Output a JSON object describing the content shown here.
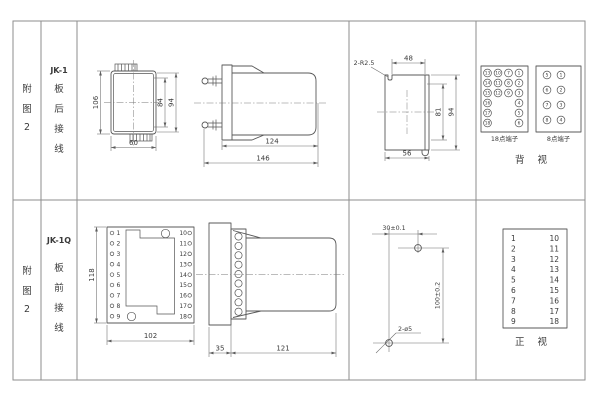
{
  "rows": {
    "r1": {
      "fig_chars": [
        "附",
        "图",
        "2"
      ],
      "model": "JK-1",
      "mount_chars": [
        "板",
        "后",
        "接",
        "线"
      ],
      "front": {
        "h": "106",
        "h84": "84",
        "h94": "94",
        "w": "60"
      },
      "side": {
        "body": "124",
        "total": "146"
      },
      "cutout": {
        "note": "2-R2.5",
        "top": "48",
        "h81": "81",
        "h94": "94",
        "bottom": "56"
      },
      "t18": {
        "label": "18点端子",
        "grid": [
          [
            "13",
            "10",
            "7",
            "1"
          ],
          [
            "14",
            "11",
            "8",
            "2"
          ],
          [
            "15",
            "12",
            "9",
            "3"
          ]
        ],
        "left": [
          "16",
          "17",
          "18"
        ],
        "right": [
          "4",
          "5",
          "6"
        ]
      },
      "t8": {
        "label": "8点端子",
        "left": [
          "5",
          "6",
          "7",
          "8"
        ],
        "right": [
          "1",
          "2",
          "3",
          "4"
        ]
      },
      "view": "背视"
    },
    "r2": {
      "fig_chars": [
        "附",
        "图",
        "2"
      ],
      "model": "JK-1Q",
      "mount_chars": [
        "板",
        "前",
        "接",
        "线"
      ],
      "front": {
        "h": "118",
        "w": "102",
        "left": [
          "1",
          "2",
          "3",
          "4",
          "5",
          "6",
          "7",
          "8",
          "9"
        ],
        "right": [
          "10",
          "11",
          "12",
          "13",
          "14",
          "15",
          "16",
          "17",
          "18"
        ]
      },
      "side": {
        "plate": "35",
        "body": "121"
      },
      "drill": {
        "dx": "30±0.1",
        "dy": "100±0.2",
        "note": "2-ø5"
      },
      "ttable": {
        "left": [
          "1",
          "2",
          "3",
          "4",
          "5",
          "6",
          "7",
          "8",
          "9"
        ],
        "right": [
          "10",
          "11",
          "12",
          "13",
          "14",
          "15",
          "16",
          "17",
          "18"
        ]
      },
      "view": "正视"
    }
  }
}
